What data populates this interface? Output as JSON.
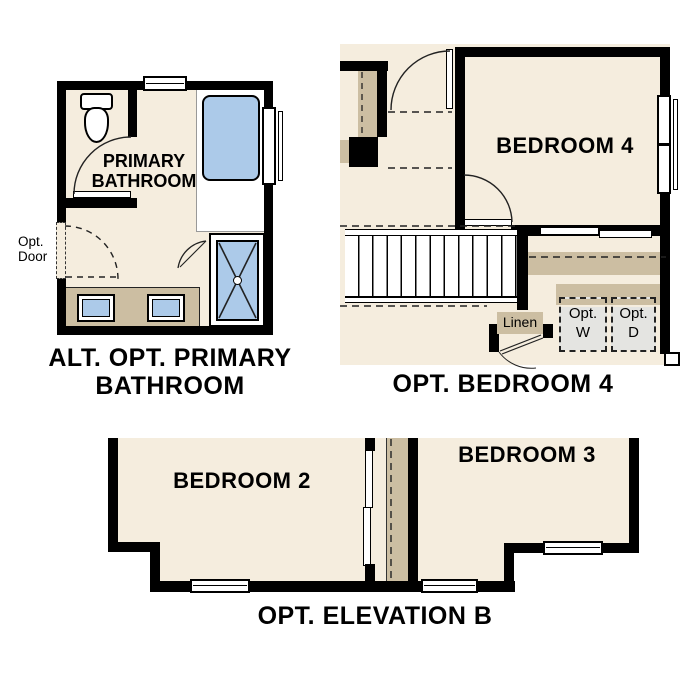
{
  "colors": {
    "wall": "#000000",
    "floor": "#f5edde",
    "cabinet_tan": "#ccbea2",
    "fixture_blue": "#accae9",
    "appliance_gray": "#e4e4e1"
  },
  "bathroom_plan": {
    "title_line1": "ALT. OPT. PRIMARY",
    "title_line2": "BATHROOM",
    "room_line1": "PRIMARY",
    "room_line2": "BATHROOM",
    "opt_door_line1": "Opt.",
    "opt_door_line2": "Door"
  },
  "bedroom4_plan": {
    "title": "OPT. BEDROOM 4",
    "room_label": "BEDROOM 4",
    "linen_label": "Linen",
    "washer_line1": "Opt.",
    "washer_line2": "W",
    "dryer_line1": "Opt.",
    "dryer_line2": "D"
  },
  "elevation_plan": {
    "title": "OPT. ELEVATION B",
    "bedroom2_label": "BEDROOM 2",
    "bedroom3_label": "BEDROOM 3"
  }
}
